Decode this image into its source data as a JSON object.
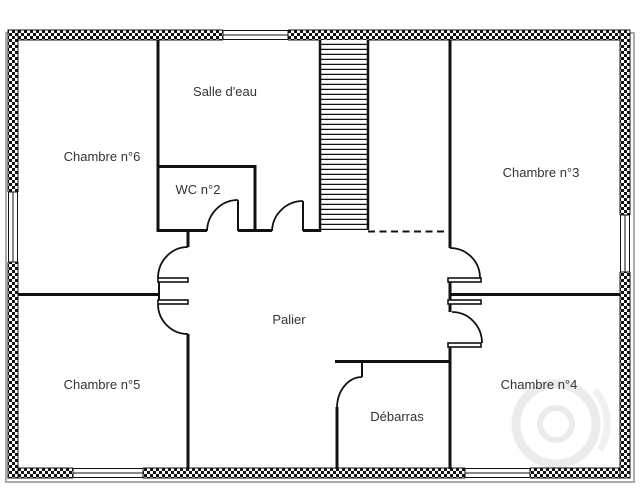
{
  "plan": {
    "type": "floor-plan",
    "rooms": {
      "salle_deau": "Salle d'eau",
      "chambre6": "Chambre n°6",
      "wc2": "WC n°2",
      "chambre3": "Chambre n°3",
      "palier": "Palier",
      "chambre5": "Chambre n°5",
      "chambre4": "Chambre n°4",
      "debarras": "Débarras"
    },
    "features": {
      "staircase": "staircase",
      "window_count": 5,
      "door_count": 7
    },
    "colors": {
      "wall": "#111111",
      "label": "#333333",
      "background": "#ffffff",
      "shadow": "#aaaaaa",
      "watermark": "#ebebeb"
    }
  }
}
